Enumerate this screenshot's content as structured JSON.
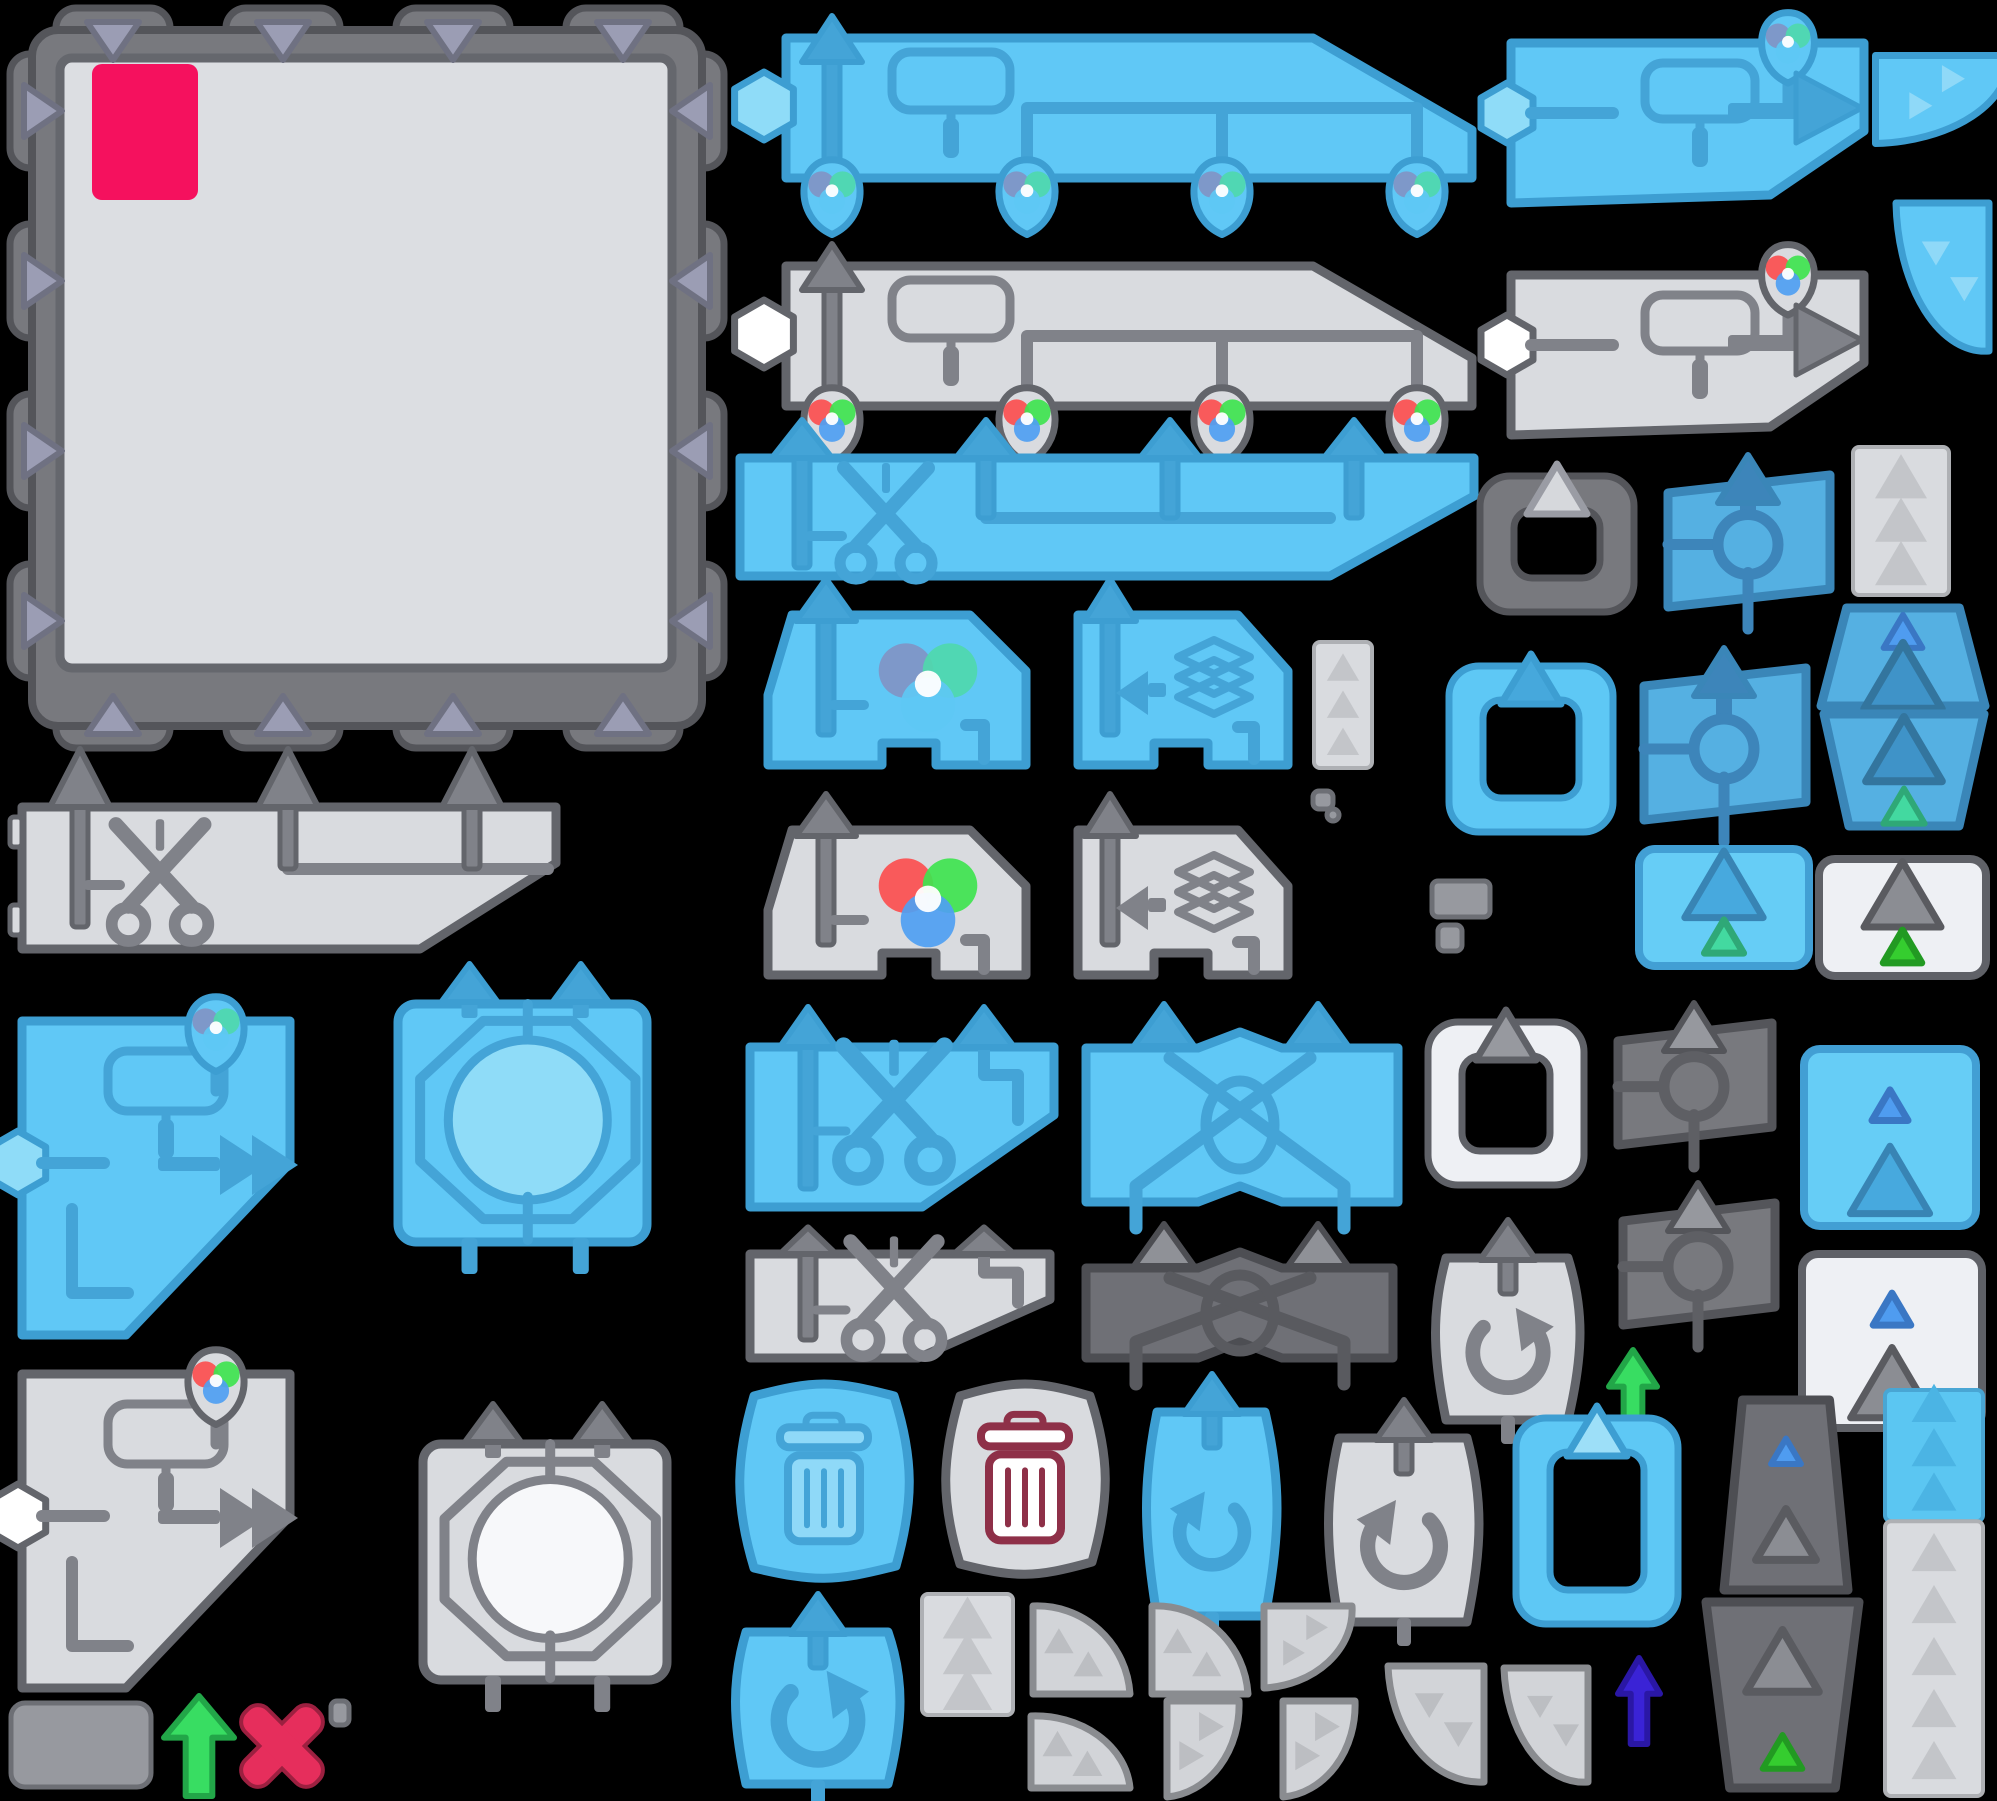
{
  "canvas": {
    "width": 1997,
    "height": 1801,
    "background": "#000000"
  },
  "palette": {
    "blue": {
      "body": "#60c8f6",
      "border": "#3d9ed2",
      "icon": "#44a4d7",
      "soft": "#8fdcf8"
    },
    "blue2": {
      "body": "#55b0e2",
      "border": "#3a86b8",
      "icon": "#3d85ba"
    },
    "lightblue": {
      "body": "#66cdf6",
      "border": "#429fd4"
    },
    "gray": {
      "body": "#d9dbdf",
      "border": "#63656b",
      "icon": "#808289"
    },
    "white": {
      "body": "#eef0f4",
      "border": "#5f6167",
      "icon": "#8d8f97"
    },
    "dark": {
      "body": "#78797e",
      "border": "#54555a",
      "icon": "#5e5f64",
      "iconLight": "#96989e"
    },
    "darker": {
      "body": "#6f7076",
      "border": "#4d4e53"
    },
    "panel": "#dcdee2",
    "panelBorder": "#65676d",
    "lavender": "#9b9db4",
    "lavenderBorder": "#6f7182",
    "pink": "#f5115e",
    "green": "#38dd62",
    "greenBorder": "#22a648",
    "indigo": "#3a23d6",
    "indigoBorder": "#2a17a5",
    "red": "#e62e5c",
    "redBorder": "#9c2040",
    "trashRed": "#8e3048",
    "triBlue": "#4f9cf0",
    "triBlueBorder": "#3a77c4",
    "triGreen": "#43d9a0",
    "triGreenBorder": "#2fa877",
    "triBrightGreen": "#35cd2f",
    "triBrightGreenBorder": "#229a22",
    "beltTri": "#c3c5c9",
    "vennBright": {
      "r": "#fc4f4f",
      "g": "#3fe44f",
      "b": "#4f9ff2"
    },
    "vennMuted": {
      "r": "#8194c4",
      "g": "#4fd8ac",
      "b": "#5ec8f4"
    }
  },
  "sprites": [
    {
      "name": "puzzle-board",
      "kind": "board",
      "x": 8,
      "y": 6,
      "w": 718,
      "h": 744
    },
    {
      "name": "paint-machine-blue",
      "kind": "machine",
      "v": "blue",
      "x": 740,
      "y": 10,
      "w": 748,
      "h": 218
    },
    {
      "name": "paint-machine-gray",
      "kind": "machine",
      "v": "gray",
      "x": 740,
      "y": 238,
      "w": 748,
      "h": 175
    },
    {
      "name": "painter-blue",
      "kind": "painter",
      "v": "blue",
      "x": 1495,
      "y": 13,
      "w": 385,
      "h": 200
    },
    {
      "name": "painter-gray",
      "kind": "painter",
      "v": "gray",
      "x": 1495,
      "y": 245,
      "w": 385,
      "h": 195
    },
    {
      "name": "curve-blue-1",
      "kind": "curve",
      "v": "blue",
      "rot": 90,
      "x": 1893,
      "y": 22,
      "w": 104,
      "h": 155
    },
    {
      "name": "curve-blue-2",
      "kind": "curve",
      "v": "blue",
      "rot": 180,
      "x": 1888,
      "y": 195,
      "w": 109,
      "h": 170
    },
    {
      "name": "cutter-long-blue",
      "kind": "cutter",
      "v": "blue",
      "x": 720,
      "y": 418,
      "w": 770,
      "h": 172
    },
    {
      "name": "cutter-strip-gray",
      "kind": "cutterStrip",
      "v": "gray",
      "x": 8,
      "y": 745,
      "w": 562,
      "h": 212
    },
    {
      "name": "clipboard-frame-dark",
      "kind": "frame",
      "v": "dark",
      "x": 1472,
      "y": 450,
      "w": 170,
      "h": 172
    },
    {
      "name": "reader-blue-small",
      "kind": "reader",
      "v": "blue2",
      "x": 1650,
      "y": 447,
      "w": 196,
      "h": 168
    },
    {
      "name": "belt-strip-gray-1",
      "kind": "strip",
      "v": "gray",
      "tris": 3,
      "x": 1851,
      "y": 445,
      "w": 100,
      "h": 152
    },
    {
      "name": "frame-blue",
      "kind": "frame",
      "v": "blue",
      "tri": "solid",
      "x": 1441,
      "y": 640,
      "w": 180,
      "h": 202
    },
    {
      "name": "reader-blue-large",
      "kind": "reader",
      "v": "blue2",
      "x": 1626,
      "y": 640,
      "w": 196,
      "h": 188
    },
    {
      "name": "trapezoid-blue-top",
      "kind": "trap",
      "v": "blue2",
      "dir": "top",
      "tri": "blue",
      "x": 1815,
      "y": 600,
      "w": 176,
      "h": 108
    },
    {
      "name": "trapezoid-blue-bottom",
      "kind": "trap",
      "v": "blue2",
      "dir": "bottom",
      "tri": "green",
      "x": 1818,
      "y": 712,
      "w": 172,
      "h": 122
    },
    {
      "name": "mixer-blue",
      "kind": "mixer",
      "v": "blue",
      "x": 730,
      "y": 575,
      "w": 308,
      "h": 200
    },
    {
      "name": "stacker-blue",
      "kind": "stacker",
      "v": "blue",
      "x": 1048,
      "y": 575,
      "w": 242,
      "h": 200
    },
    {
      "name": "mixer-gray",
      "kind": "mixer",
      "v": "gray",
      "x": 730,
      "y": 790,
      "w": 308,
      "h": 195
    },
    {
      "name": "stacker-gray",
      "kind": "stacker",
      "v": "gray",
      "x": 1048,
      "y": 790,
      "w": 242,
      "h": 195
    },
    {
      "name": "belt-strip-gray-small",
      "kind": "strip",
      "v": "gray",
      "tris": 3,
      "x": 1312,
      "y": 640,
      "w": 62,
      "h": 130
    },
    {
      "name": "bit-1",
      "kind": "bit",
      "x": 1312,
      "y": 790,
      "w": 22,
      "h": 20
    },
    {
      "name": "bit-2",
      "kind": "bit",
      "x": 1326,
      "y": 808,
      "w": 14,
      "h": 14
    },
    {
      "name": "panel-blue-green",
      "kind": "panelTri",
      "v": "lightblue",
      "tris": [
        "bigblue",
        "green"
      ],
      "x": 1635,
      "y": 845,
      "w": 178,
      "h": 125
    },
    {
      "name": "panel-white-green",
      "kind": "panelTri",
      "v": "white",
      "tris": [
        "biggray",
        "brightgreen"
      ],
      "x": 1815,
      "y": 855,
      "w": 175,
      "h": 125
    },
    {
      "name": "octagon-piece-blue",
      "kind": "octa",
      "v": "blue",
      "x": 390,
      "y": 960,
      "w": 265,
      "h": 320
    },
    {
      "name": "painter-big-blue",
      "kind": "bigPainter",
      "v": "blue",
      "x": 8,
      "y": 995,
      "w": 296,
      "h": 345
    },
    {
      "name": "half-cutter-blue",
      "kind": "halfCutter",
      "v": "blue",
      "x": 732,
      "y": 1005,
      "w": 340,
      "h": 210
    },
    {
      "name": "swapper-blue",
      "kind": "swapper",
      "v": "blue",
      "x": 1072,
      "y": 1002,
      "w": 340,
      "h": 210
    },
    {
      "name": "reader-dark-1",
      "kind": "reader",
      "v": "dark",
      "x": 1600,
      "y": 995,
      "w": 188,
      "h": 158
    },
    {
      "name": "panel-blue-tris",
      "kind": "panelTri",
      "v": "lightblue",
      "tris": [
        "smallblue",
        "bigblue"
      ],
      "x": 1800,
      "y": 1045,
      "w": 180,
      "h": 185
    },
    {
      "name": "frame-white",
      "kind": "frame",
      "v": "white",
      "x": 1420,
      "y": 996,
      "w": 172,
      "h": 199
    },
    {
      "name": "bit-3",
      "kind": "bit",
      "x": 1431,
      "y": 880,
      "w": 60,
      "h": 38
    },
    {
      "name": "bit-4",
      "kind": "bit",
      "x": 1437,
      "y": 924,
      "w": 26,
      "h": 28
    },
    {
      "name": "half-cutter-gray",
      "kind": "halfCutter",
      "v": "gray",
      "x": 732,
      "y": 1226,
      "w": 336,
      "h": 140
    },
    {
      "name": "swapper-dark",
      "kind": "swapper",
      "v": "dark",
      "x": 1072,
      "y": 1222,
      "w": 335,
      "h": 146
    },
    {
      "name": "rotator-gray-cw",
      "kind": "rotator",
      "v": "gray",
      "dir": "cw",
      "x": 1420,
      "y": 1218,
      "w": 176,
      "h": 216
    },
    {
      "name": "reader-dark-2",
      "kind": "reader",
      "v": "dark",
      "x": 1605,
      "y": 1175,
      "w": 186,
      "h": 158
    },
    {
      "name": "green-arrow-right",
      "kind": "garrow",
      "v": "green",
      "x": 1607,
      "y": 1348,
      "w": 52,
      "h": 92
    },
    {
      "name": "panel-white-blue",
      "kind": "panelTri",
      "v": "white",
      "tris": [
        "smallblue",
        "biggray"
      ],
      "x": 1798,
      "y": 1250,
      "w": 188,
      "h": 182
    },
    {
      "name": "painter-big-gray",
      "kind": "bigPainter",
      "v": "gray",
      "x": 8,
      "y": 1348,
      "w": 296,
      "h": 345
    },
    {
      "name": "octagon-piece-white",
      "kind": "octa",
      "v": "white",
      "x": 415,
      "y": 1400,
      "w": 260,
      "h": 318
    },
    {
      "name": "trash-blue",
      "kind": "trash",
      "v": "blue",
      "x": 724,
      "y": 1372,
      "w": 200,
      "h": 216
    },
    {
      "name": "trash-gray",
      "kind": "trash",
      "v": "gray",
      "x": 930,
      "y": 1372,
      "w": 190,
      "h": 212
    },
    {
      "name": "rotator-blue-ccw",
      "kind": "rotator",
      "v": "blue",
      "dir": "ccw",
      "x": 1131,
      "y": 1372,
      "w": 162,
      "h": 258
    },
    {
      "name": "rotator-gray-ccw",
      "kind": "rotator",
      "v": "gray",
      "dir": "ccw",
      "x": 1313,
      "y": 1398,
      "w": 182,
      "h": 238
    },
    {
      "name": "frame-blue-paste",
      "kind": "frame",
      "v": "blue",
      "tri": "light",
      "x": 1508,
      "y": 1392,
      "w": 178,
      "h": 242
    },
    {
      "name": "trap-dark-top",
      "kind": "trap",
      "v": "dark",
      "dir": "top",
      "tri": "blue",
      "x": 1718,
      "y": 1392,
      "w": 136,
      "h": 200
    },
    {
      "name": "trap-dark-bottom",
      "kind": "trap",
      "v": "dark",
      "dir": "bottom",
      "tri": "brightgreen",
      "x": 1700,
      "y": 1600,
      "w": 165,
      "h": 196
    },
    {
      "name": "belt-strip-blue-gray",
      "kind": "strip",
      "v": "bluegray",
      "tris": 8,
      "x": 1883,
      "y": 1388,
      "w": 102,
      "h": 410
    },
    {
      "name": "arrow-indigo",
      "kind": "garrow",
      "v": "indigo",
      "x": 1616,
      "y": 1656,
      "w": 46,
      "h": 90
    },
    {
      "name": "rotator-blue-cw",
      "kind": "rotator",
      "v": "blue",
      "dir": "cw",
      "x": 720,
      "y": 1592,
      "w": 196,
      "h": 206
    },
    {
      "name": "belt-strip-gray-2",
      "kind": "strip",
      "v": "gray",
      "tris": 3,
      "x": 920,
      "y": 1592,
      "w": 95,
      "h": 125
    },
    {
      "name": "curve-gray-a1",
      "kind": "curve",
      "v": "gray",
      "rot": 0,
      "x": 1025,
      "y": 1592,
      "w": 113,
      "h": 110
    },
    {
      "name": "curve-gray-a2",
      "kind": "curve",
      "v": "gray",
      "rot": 0,
      "x": 1144,
      "y": 1592,
      "w": 112,
      "h": 110
    },
    {
      "name": "curve-gray-a3",
      "kind": "curve",
      "v": "gray",
      "rot": 90,
      "x": 1262,
      "y": 1592,
      "w": 98,
      "h": 110
    },
    {
      "name": "curve-gray-b1",
      "kind": "curve",
      "v": "gray",
      "rot": 0,
      "x": 1023,
      "y": 1702,
      "w": 115,
      "h": 94
    },
    {
      "name": "curve-gray-b2",
      "kind": "curve",
      "v": "gray",
      "rot": 90,
      "x": 1150,
      "y": 1702,
      "w": 112,
      "h": 94
    },
    {
      "name": "curve-gray-b3",
      "kind": "curve",
      "v": "gray",
      "rot": 90,
      "x": 1266,
      "y": 1702,
      "w": 112,
      "h": 94
    },
    {
      "name": "curve-gray-b4",
      "kind": "curve",
      "v": "gray",
      "rot": 180,
      "x": 1380,
      "y": 1658,
      "w": 112,
      "h": 138
    },
    {
      "name": "curve-gray-b5",
      "kind": "curve",
      "v": "gray",
      "rot": 180,
      "x": 1496,
      "y": 1660,
      "w": 100,
      "h": 136
    },
    {
      "name": "gray-plate",
      "kind": "bit",
      "rx": 14,
      "x": 10,
      "y": 1702,
      "w": 142,
      "h": 86
    },
    {
      "name": "green-arrow-bottom",
      "kind": "garrow",
      "v": "green",
      "x": 162,
      "y": 1694,
      "w": 74,
      "h": 104
    },
    {
      "name": "red-cross",
      "kind": "cross",
      "x": 242,
      "y": 1704,
      "w": 80,
      "h": 84
    },
    {
      "name": "bit-5",
      "kind": "bit",
      "x": 330,
      "y": 1700,
      "w": 20,
      "h": 26
    }
  ]
}
